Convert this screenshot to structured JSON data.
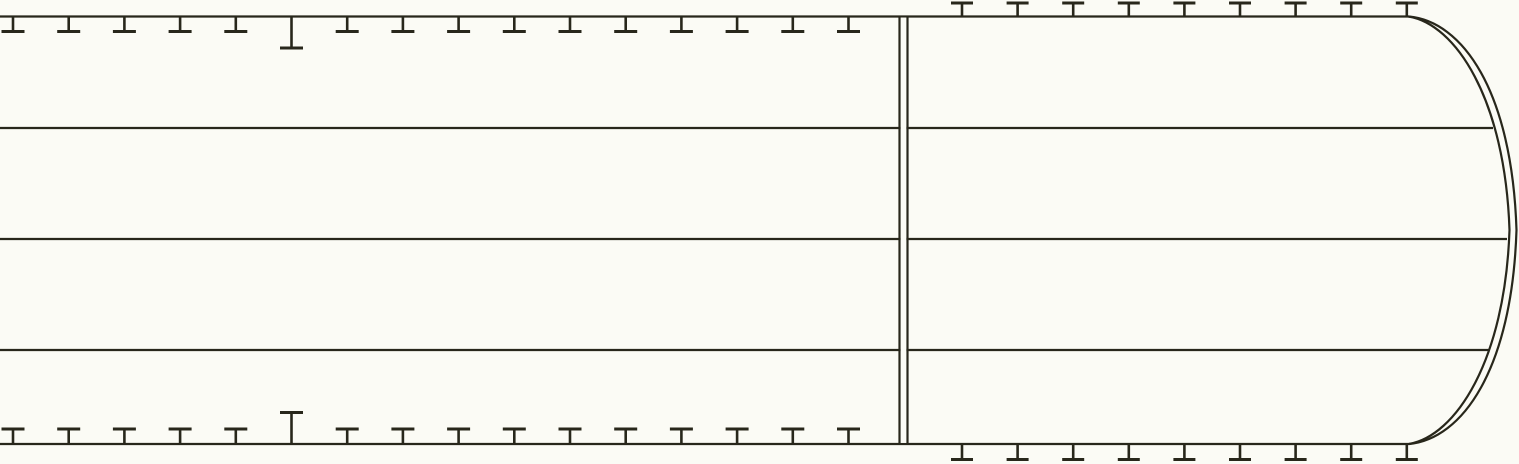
{
  "canvas": {
    "width": 1519,
    "height": 464,
    "background": "#fbfbf5",
    "line_color": "#28271b"
  },
  "deck_plan": {
    "horizontal_lines": [
      {
        "name": "top-deck-edge-line",
        "y": 16.5,
        "x1": 0,
        "x2": 1408.5
      },
      {
        "name": "deck-line-upper",
        "y": 128,
        "x1": 0,
        "x2": 1493
      },
      {
        "name": "deck-line-middle",
        "y": 239,
        "x1": 0,
        "x2": 1507
      },
      {
        "name": "deck-line-lower",
        "y": 350,
        "x1": 0,
        "x2": 1489
      },
      {
        "name": "bottom-deck-edge-line",
        "y": 444,
        "x1": 0,
        "x2": 1409
      }
    ],
    "double_joint_line": {
      "x_left": 899.5,
      "x_right": 907.5,
      "y1": 16.5,
      "y2": 444
    },
    "stern_curves": {
      "outer_path": "M 1408.5,16.5 C 1462,21 1512,90 1516.5,230 C 1512,370 1462,439 1409,444",
      "inner_path": "M 1408.5,16.5 C 1455,24 1505,98 1509.5,230 C 1505,362 1455,436 1409,444"
    },
    "left_ticks": {
      "start_x": 13,
      "spacing": 55.7,
      "count": 16,
      "long_index": 5,
      "normal_length": 15,
      "long_length": 31.5,
      "crossbar_half_width": 11.5,
      "top_attach_y": 16.5,
      "bottom_attach_y": 444,
      "direction": "inward"
    },
    "right_ticks": {
      "start_x": 962,
      "spacing": 55.6,
      "count": 9,
      "top_length": 13.5,
      "bottom_length": 15.5,
      "crossbar_half_width": 11,
      "top_attach_y": 16.5,
      "bottom_attach_y": 444,
      "direction": "outward"
    },
    "stroke": {
      "line_width": 2.2,
      "tick_stem_width": 2.6,
      "tick_bar_width": 3
    }
  }
}
